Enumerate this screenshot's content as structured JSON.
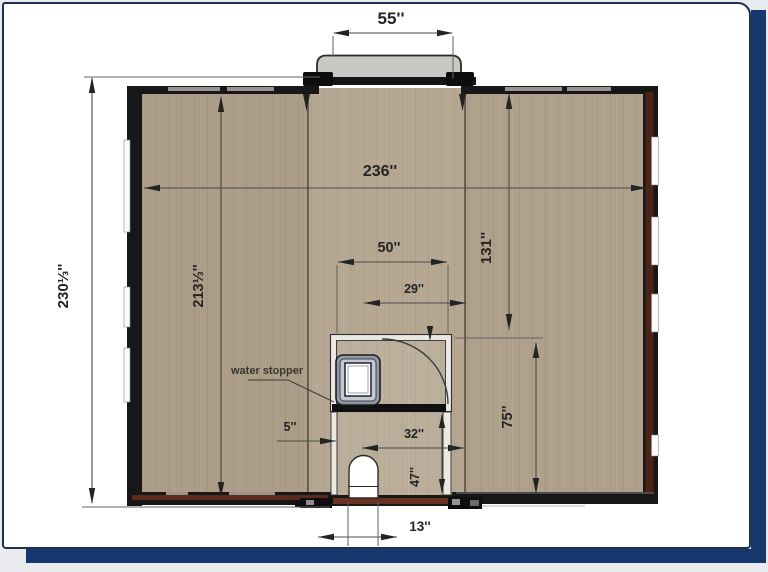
{
  "slide": {
    "colors": {
      "accent_navy": "#17386e",
      "card_border": "#223050",
      "page_background": "#e9ebee"
    }
  },
  "floor_plan": {
    "colors": {
      "floor_tan": "#b2a38d",
      "wall_dark": "#171717",
      "wall_red_brown": "#4d2318",
      "canopy_gray": "#c9c8c4",
      "shower_frame": "#8f97a8"
    },
    "annotations": {
      "water_stopper": "water stopper"
    },
    "dimensions": {
      "canopy_width": "55''",
      "overall_depth": "230⅓''",
      "interior_width": "236''",
      "interior_depth": "213⅓''",
      "bathroom_width": "50''",
      "door_clearance": "29''",
      "right_front_depth": "131''",
      "right_rear_depth": "75''",
      "step_gap": "5''",
      "rear_room_width": "32''",
      "rear_room_depth": "47''",
      "entry_width": "13''"
    }
  }
}
